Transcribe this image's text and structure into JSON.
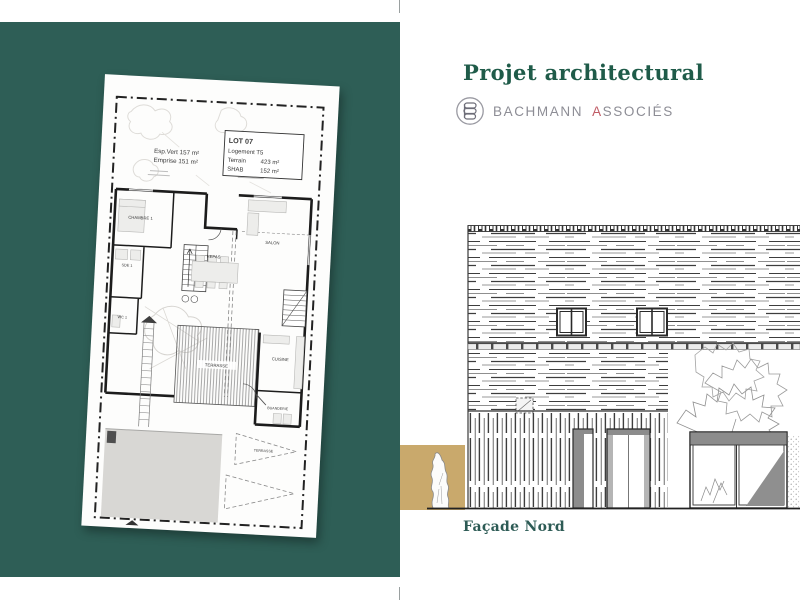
{
  "colors": {
    "panel_teal": "#2e5e56",
    "accent_tan": "#c9a96c",
    "title_green": "#1f5b49",
    "caption_teal": "#2d5b55",
    "brand_gray": "#8d8d95",
    "brand_red": "#c05c66"
  },
  "title": "Projet architectural",
  "brand": {
    "logo_icon": "bachmann-monogram-icon",
    "word1": "BACHMANN",
    "word2_initial": "A",
    "word2_rest": "SSOCIÉS"
  },
  "plan": {
    "esp_vert": "Esp.Vert 157 m²",
    "emprise": "Emprise 151 m²",
    "lot": {
      "title": "LOT 07",
      "logement": "Logement T5",
      "terrain_label": "Terrain",
      "terrain_value": "423 m²",
      "shab_label": "SHAB",
      "shab_value": "152 m²"
    },
    "rooms": {
      "chambre1": "CHAMBRE 1",
      "sde1": "SDE 1",
      "wc1": "WC 1",
      "salon": "SALON",
      "repas": "REPAS",
      "terrasse": "TERRASSE",
      "cuisine": "CUISINE",
      "buanderie": "BUANDERIE",
      "terrasse_ext": "TERRASSE"
    }
  },
  "facade": {
    "caption": "Façade Nord"
  }
}
